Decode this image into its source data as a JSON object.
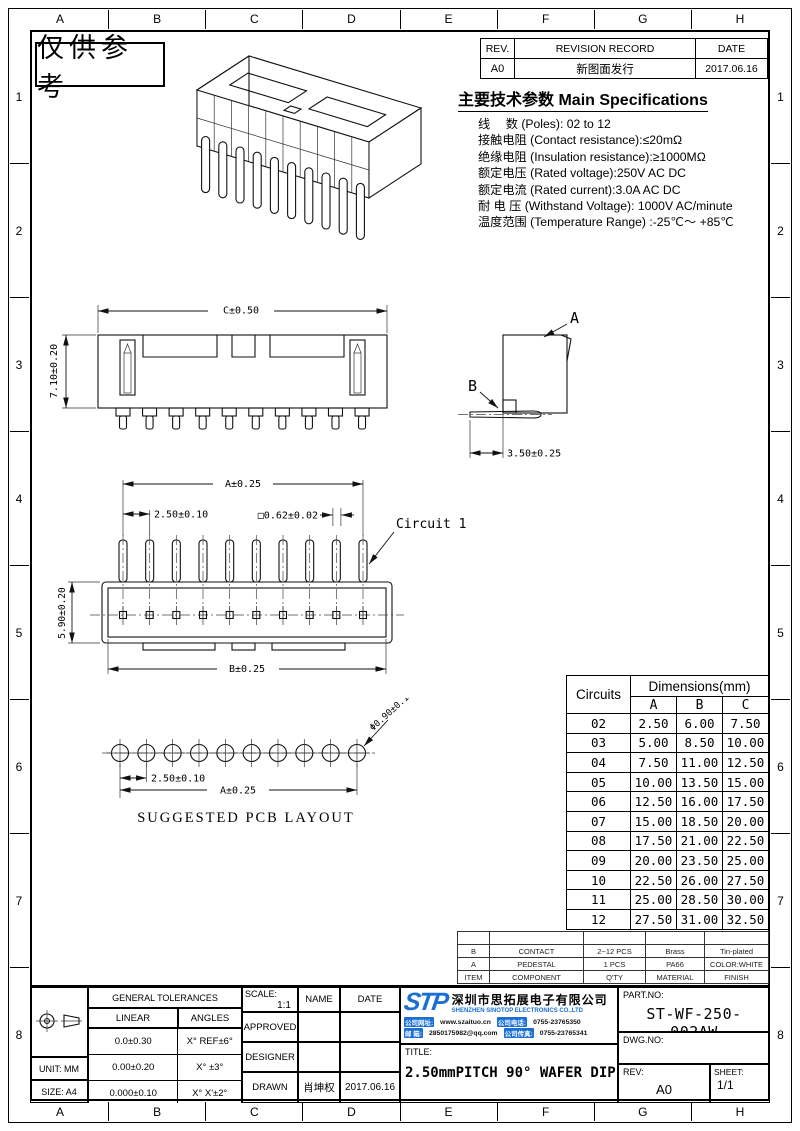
{
  "stamp": "仅供参考",
  "border": {
    "columns": [
      "A",
      "B",
      "C",
      "D",
      "E",
      "F",
      "G",
      "H"
    ],
    "rows": [
      "1",
      "2",
      "3",
      "4",
      "5",
      "6",
      "7",
      "8"
    ]
  },
  "revision": {
    "rev_header": "REV.",
    "record_header": "REVISION RECORD",
    "date_header": "DATE",
    "rev": "A0",
    "record": "新图面发行",
    "date": "2017.06.16"
  },
  "specs": {
    "title_cn": "主要技术参数",
    "title_en": "Main Specifications",
    "lines": [
      "线　 数 (Poles): 02 to 12",
      "接触电阻 (Contact resistance):≤20mΩ",
      "绝缘电阻 (Insulation resistance):≥1000MΩ",
      "额定电压 (Rated voltage):250V AC DC",
      "额定电流 (Rated current):3.0A AC DC",
      "耐 电 压 (Withstand Voltage): 1000V AC/minute",
      "温度范围 (Temperature Range) :-25℃～ +85℃"
    ]
  },
  "views": {
    "pin_count": 10,
    "front": {
      "width": "C±0.50",
      "height": "7.10±0.20"
    },
    "side": {
      "a": "A",
      "b": "B",
      "depth": "3.50±0.25"
    },
    "top": {
      "overall": "A±0.25",
      "pitch": "2.50±0.10",
      "pin_square": "□0.62±0.02",
      "circuit": "Circuit 1",
      "height": "5.90±0.20",
      "body": "B±0.25"
    },
    "pcb": {
      "pitch": "2.50±0.10",
      "overall": "A±0.25",
      "hole": "Φ0.90±0.10",
      "caption": "SUGGESTED PCB LAYOUT"
    }
  },
  "dimensions_table": {
    "circuits_header": "Circuits",
    "group_header": "Dimensions(mm)",
    "columns": [
      "A",
      "B",
      "C"
    ],
    "rows": [
      [
        "02",
        "2.50",
        "6.00",
        "7.50"
      ],
      [
        "03",
        "5.00",
        "8.50",
        "10.00"
      ],
      [
        "04",
        "7.50",
        "11.00",
        "12.50"
      ],
      [
        "05",
        "10.00",
        "13.50",
        "15.00"
      ],
      [
        "06",
        "12.50",
        "16.00",
        "17.50"
      ],
      [
        "07",
        "15.00",
        "18.50",
        "20.00"
      ],
      [
        "08",
        "17.50",
        "21.00",
        "22.50"
      ],
      [
        "09",
        "20.00",
        "23.50",
        "25.00"
      ],
      [
        "10",
        "22.50",
        "26.00",
        "27.50"
      ],
      [
        "11",
        "25.00",
        "28.50",
        "30.00"
      ],
      [
        "12",
        "27.50",
        "31.00",
        "32.50"
      ]
    ]
  },
  "bom": {
    "rows": [
      [
        "",
        "",
        "",
        "",
        ""
      ],
      [
        "B",
        "CONTACT",
        "2~12 PCS",
        "Brass",
        "Tin-plated"
      ],
      [
        "A",
        "PEDESTAL",
        "1 PCS",
        "PA66",
        "COLOR:WHITE"
      ],
      [
        "ITEM",
        "COMPONENT",
        "Q'TY",
        "MATERIAL",
        "FINISH"
      ]
    ]
  },
  "title_block": {
    "tolerances": {
      "header": "GENERAL TOLERANCES",
      "linear": "LINEAR",
      "angles": "ANGLES",
      "rows": [
        [
          "0.0±0.30",
          "X° REF±6°"
        ],
        [
          "0.00±0.20",
          "X° ±3°"
        ],
        [
          "0.000±0.10",
          "X° X'±2°"
        ]
      ]
    },
    "unit": "UNIT: MM",
    "size": "SIZE: A4",
    "scale_label": "SCALE:",
    "scale": "1:1",
    "name_label": "NAME",
    "date_label": "DATE",
    "approved": "APPROVED",
    "designer": "DESIGNER",
    "drawn": "DRAWN",
    "drawn_name": "肖坤权",
    "drawn_date": "2017.06.16",
    "company": {
      "logo": "STP",
      "cn": "深圳市思拓展电子有限公司",
      "en": "SHENZHEN SINOTOP ELECTRONICS CO.,LTD",
      "website_label": "公司网址:",
      "website": "www.szaituo.cn",
      "phone_label": "公司电话:",
      "phone": "0755-23765350",
      "email_label": "邮 箱:",
      "email": "2850175982@qq.com",
      "fax_label": "公司传真:",
      "fax": "0755-23765341"
    },
    "title_label": "TITLE:",
    "title": "2.50mmPITCH 90° WAFER DIP TYPE",
    "part_label": "PART.NO:",
    "part": "ST-WF-250-002AW",
    "dwg_label": "DWG.NO:",
    "rev_label": "REV:",
    "rev": "A0",
    "sheet_label": "SHEET:",
    "sheet": "1/1"
  },
  "colors": {
    "brand_blue": "#1a6fd4",
    "line": "#000000"
  }
}
